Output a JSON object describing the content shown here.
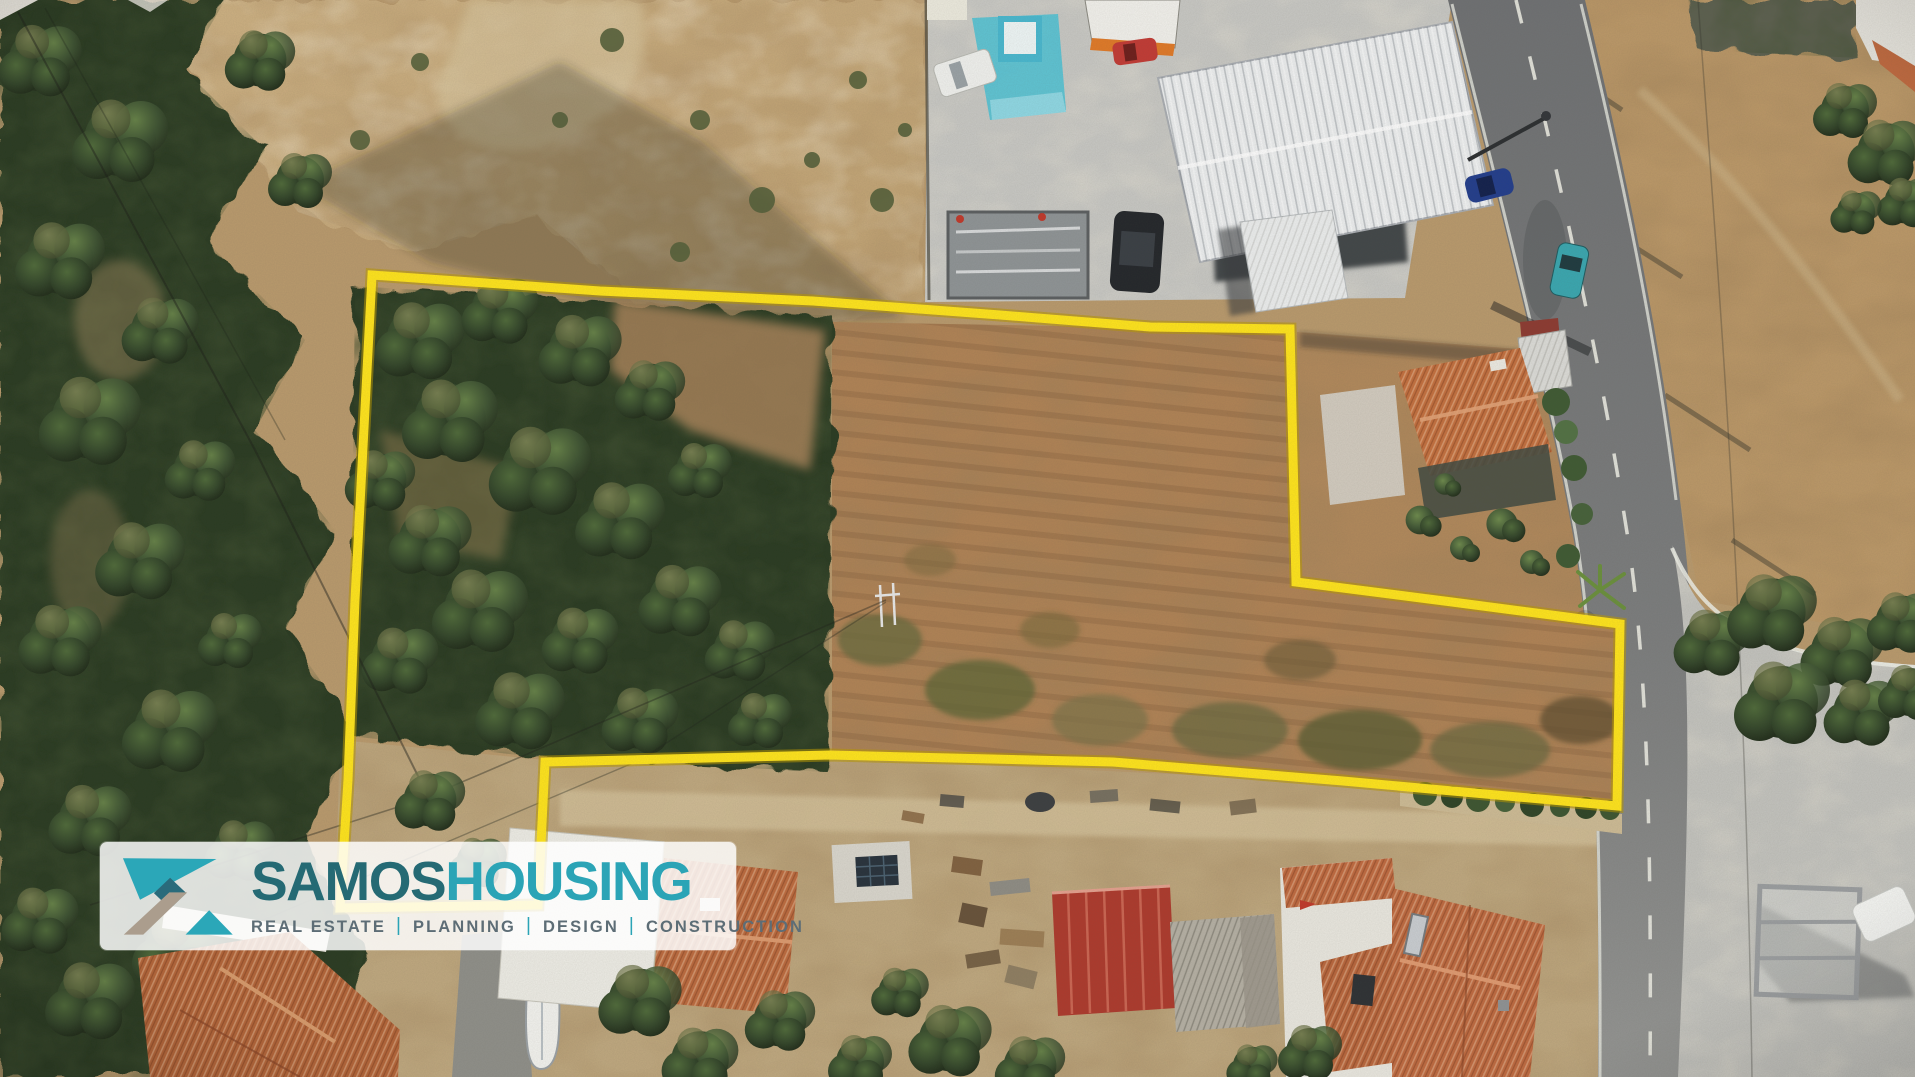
{
  "logo": {
    "brand_primary": "SAMOS",
    "brand_secondary": "HOUSING",
    "separator": "|",
    "tagline_items": [
      "REAL ESTATE",
      "PLANNING",
      "DESIGN",
      "CONSTRUCTION"
    ],
    "colors": {
      "primary_text": "#256a74",
      "secondary_text": "#2ba4b6",
      "tagline_text": "#5d6d76",
      "mark_teal": "#2ba7b8",
      "mark_dark_teal": "#2a6b7b",
      "mark_taupe": "#ab9d8d",
      "panel_bg": "rgba(255,255,255,0.84)"
    }
  },
  "scene": {
    "boundary_color": "#ffe41c",
    "colors": {
      "dry_scrub": "#c8ab7c",
      "dry_field": "#b08356",
      "olive_tree_dark": "#2e3f26",
      "road_asphalt": "#6f7173",
      "concrete": "#c8c8c4",
      "terracotta_roof": "#bf6a40",
      "warehouse_roof": "#eceeef",
      "pool_blue": "#58c3d4",
      "red_shed": "#ad3a2d"
    }
  }
}
